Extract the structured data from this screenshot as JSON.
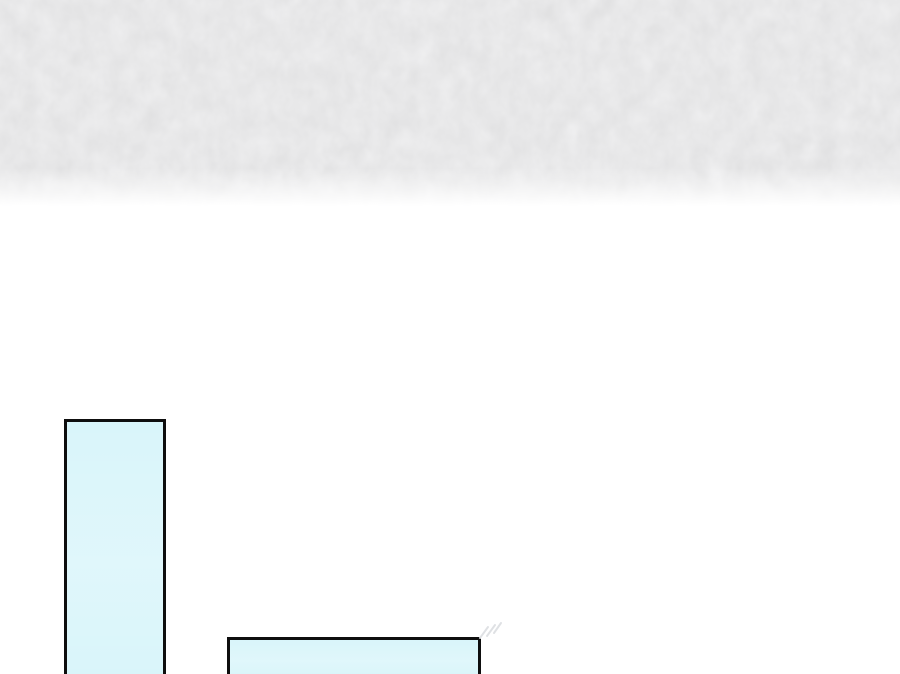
{
  "meta": {
    "description": "Cropped comic/webtoon page: subtly textured light-gray band across the top fading to a blank white page, with two black-outlined pale-cyan rectangular panels rising from the bottom edge (one tall narrow panel at left, one short wide panel right of it), plus faint speed-line ticks at the wide panel's top-right corner. No visible text.",
    "canvas_width": 900,
    "canvas_height": 674
  },
  "colors": {
    "page_background": "#ffffff",
    "top_band": "#f4f4f5",
    "panel_fill": "#d9f5fa",
    "panel_border": "#0e0e0e",
    "speedline": "#dfe1e4"
  },
  "top_band": {
    "height": 207,
    "texture": "subtle-paper-noise",
    "fade_to_white_start": 170
  },
  "panels": [
    {
      "id": "tall",
      "x": 64,
      "y": 419,
      "width": 102,
      "height": 262,
      "border_px": 3,
      "clipped_at_bottom": true
    },
    {
      "id": "wide",
      "x": 227,
      "y": 637,
      "width": 254,
      "height": 44,
      "border_px": 3,
      "clipped_at_bottom": true
    }
  ],
  "speedlines": {
    "present": true,
    "position": "top-right corner of wide panel"
  }
}
